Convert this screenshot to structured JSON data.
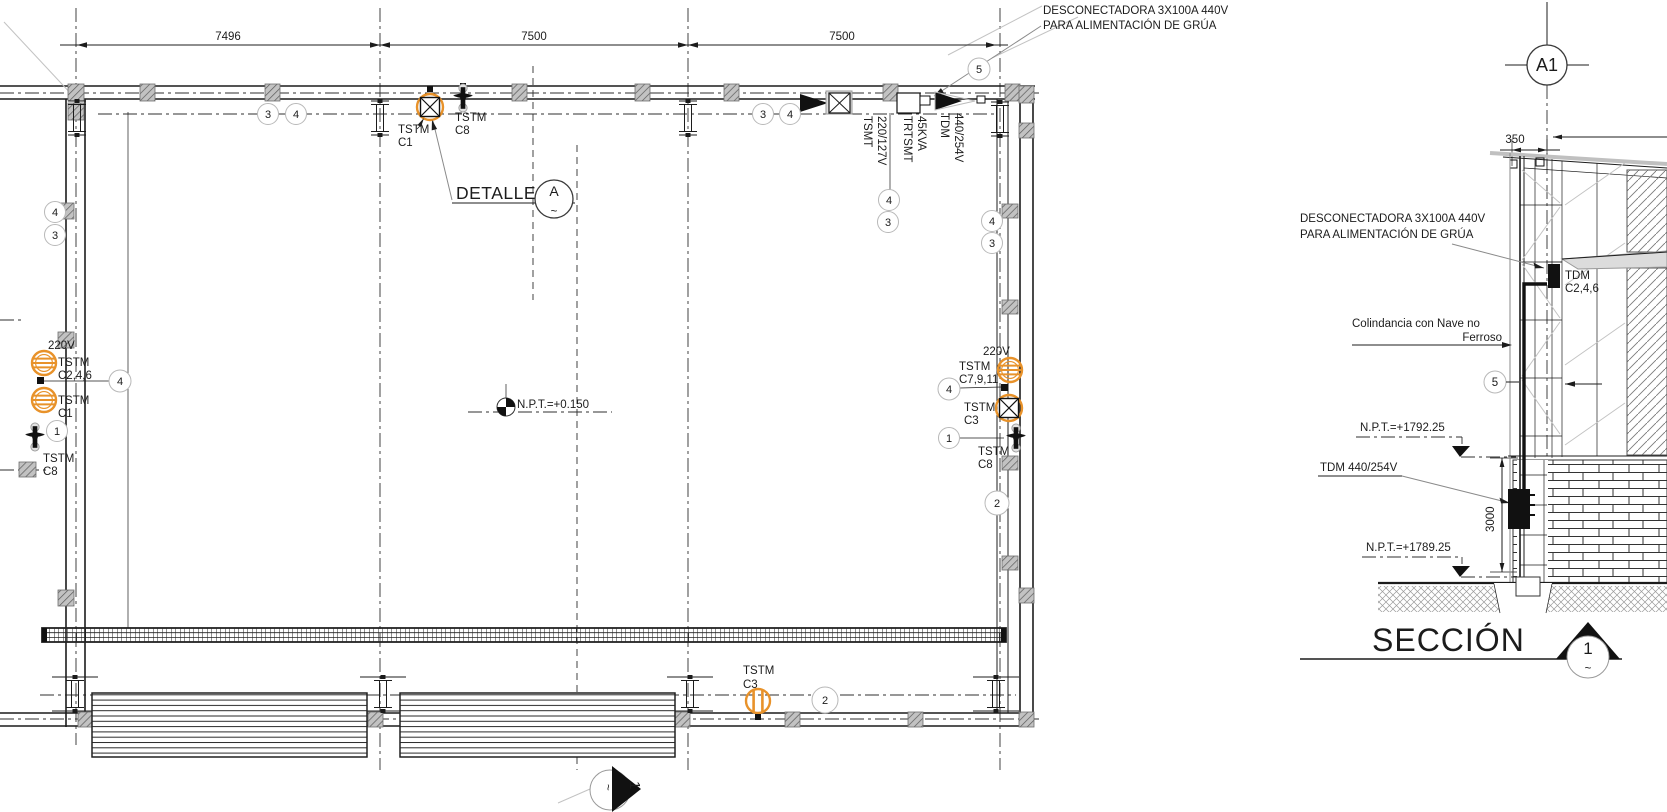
{
  "drawing": {
    "accent_orange": "#E8922A",
    "line_color": "#1c1c1c",
    "plan": {
      "dim_bay1": "7496",
      "dim_bay2": "7500",
      "dim_bay3": "7500",
      "crane_note_line1": "DESCONECTADORA 3X100A 440V",
      "crane_note_line2": "PARA ALIMENTACIÓN DE GRÚA",
      "detail_label": "DETALLE",
      "detail_bubble_letter": "A",
      "detail_bubble_sub": "~",
      "npt_level": "N.P.T.=+0.150",
      "equip_tsmt_name": "TSMT",
      "equip_tsmt_rating": "220/127V",
      "equip_trtsmt_name": "TRTSMT",
      "equip_trtsmt_rating": "45KVA",
      "equip_tdm_name": "TDM",
      "equip_tdm_rating": "440/254V",
      "left_voltage": "220V",
      "left_tstm1_label": "TSTM",
      "left_tstm1_circuits": "C2,4,6",
      "left_tstm2_label": "TSTM",
      "left_tstm2_circuits": "C1",
      "left_tstm3_label": "TSTM",
      "left_tstm3_circuits": "C8",
      "right_voltage": "220V",
      "right_tstm1_label": "TSTM",
      "right_tstm1_circuits": "C7,9,11",
      "right_tstm2_label": "TSTM",
      "right_tstm2_circuits": "C3",
      "right_tstm3_label": "TSTM",
      "right_tstm3_circuits": "C8",
      "top_tstm1_label": "TSTM",
      "top_tstm1_circuits": "C1",
      "top_tstm2_label": "TSTM",
      "top_tstm2_circuits": "C8",
      "bottom_tstm_label": "TSTM",
      "bottom_tstm_circuits": "C3",
      "cut_marker_number": "1",
      "cut_marker_sub": "~"
    },
    "keynotes": {
      "n1": "1",
      "n2": "2",
      "n3": "3",
      "n4": "4",
      "n5": "5"
    },
    "section": {
      "grid_bubble": "A1",
      "dim_offset": "350",
      "dim_height": "3000",
      "crane_note_line1": "DESCONECTADORA 3X100A 440V",
      "crane_note_line2": "PARA ALIMENTACIÓN DE GRÚA",
      "boundary_line1": "Colindancia con Nave no",
      "boundary_line2": "Ferroso",
      "tdm_label": "TDM",
      "tdm_circuits": "C2,4,6",
      "level_upper": "N.P.T.=+1792.25",
      "tdm_panel": "TDM 440/254V",
      "level_lower": "N.P.T.=+1789.25",
      "title": "SECCIÓN",
      "title_number": "1",
      "title_sub": "~"
    }
  }
}
